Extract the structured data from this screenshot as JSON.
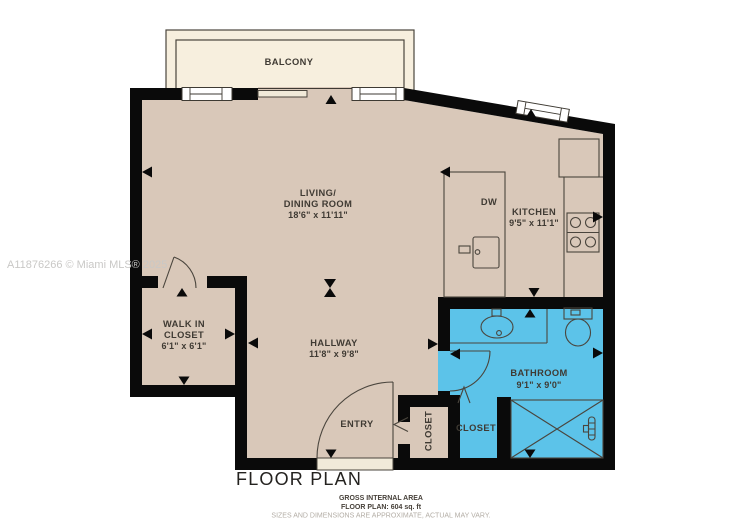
{
  "watermark": "A11876266 © Miami MLS® 2025",
  "title": "FLOOR PLAN",
  "footer": {
    "line1": "GROSS INTERNAL AREA",
    "line2": "FLOOR PLAN: 604 sq. ft",
    "line3": "SIZES AND DIMENSIONS ARE APPROXIMATE, ACTUAL MAY VARY."
  },
  "rooms": {
    "balcony": {
      "name": "BALCONY"
    },
    "living": {
      "name_line1": "LIVING/",
      "name_line2": "DINING ROOM",
      "dims": "18'6\" x 11'11\""
    },
    "kitchen": {
      "name": "KITCHEN",
      "dims": "9'5\" x 11'1\"",
      "dishwasher": "DW"
    },
    "walk_in_closet": {
      "name_line1": "WALK IN",
      "name_line2": "CLOSET",
      "dims": "6'1\" x 6'1\""
    },
    "hallway": {
      "name": "HALLWAY",
      "dims": "11'8\" x 9'8\""
    },
    "bathroom": {
      "name": "BATHROOM",
      "dims": "9'1\" x 9'0\""
    },
    "entry": {
      "name": "ENTRY"
    },
    "hall_closet": {
      "name": "CLOSET"
    },
    "bath_closet": {
      "name": "CLOSET"
    }
  },
  "colors": {
    "floor": "#d9c8b9",
    "balcony": "#f7efde",
    "bathroom": "#5cc3e9",
    "wall": "#0a0a0a",
    "line": "#4a453d",
    "text": "#3f3a33",
    "watermark": "#c9c8c6",
    "muted": "#b3ada5",
    "opening": "#f1ead9"
  }
}
